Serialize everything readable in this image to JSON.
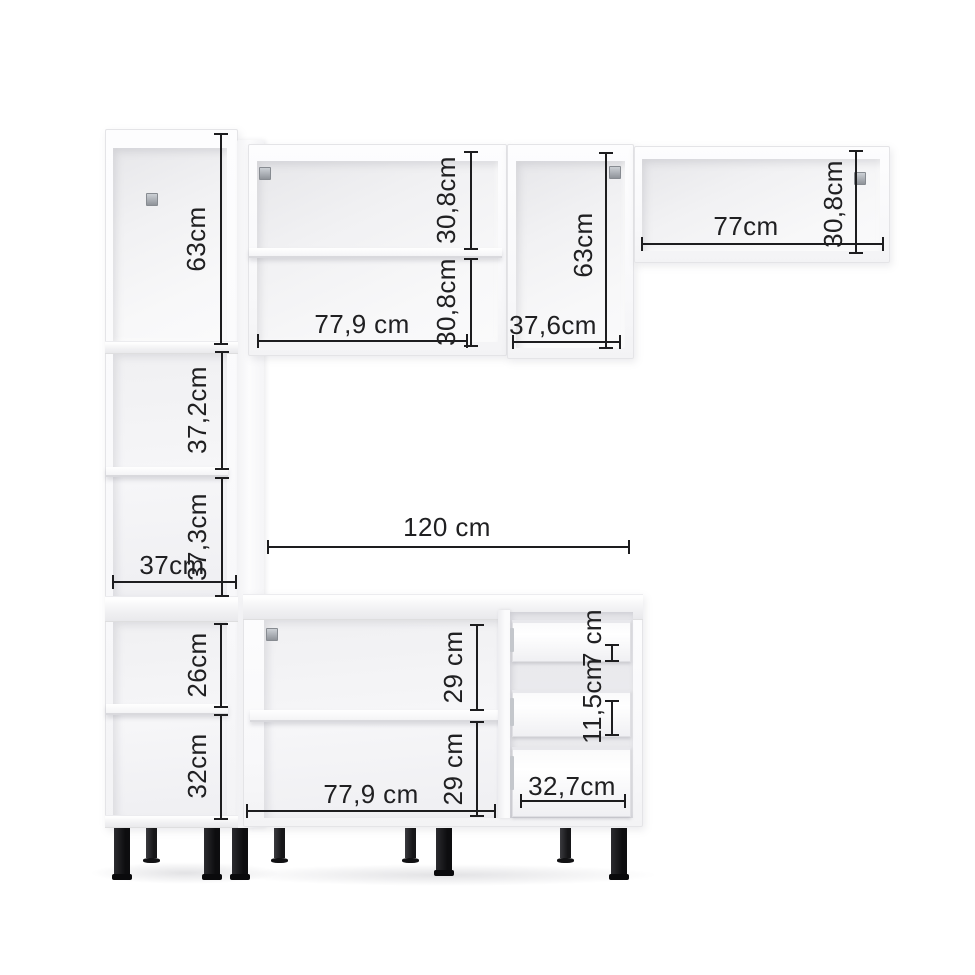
{
  "scene": {
    "background": "#ffffff",
    "dimension_line_color": "#1d1d1f",
    "label_color": "#202022",
    "cabinet_color": "#fbfbfd",
    "interior_shade_color": "#e9e9ec",
    "leg_color": "#141416",
    "hinge_color": "#a8acb2"
  },
  "cabinets": {
    "tall_left": {
      "dims": {
        "upper_height": "63cm",
        "niche_upper_height": "37,2cm",
        "niche_lower_height": "37,3cm",
        "width": "37cm",
        "base_upper_height": "26cm",
        "base_lower_height": "32cm"
      }
    },
    "wall_wide": {
      "dims": {
        "section_upper_height": "30,8cm",
        "section_lower_height": "30,8cm",
        "width": "77,9 cm"
      }
    },
    "wall_tall": {
      "dims": {
        "width": "37,6cm",
        "height": "63cm"
      }
    },
    "wall_right": {
      "dims": {
        "width": "77cm",
        "height": "30,8cm"
      }
    },
    "base_wide": {
      "dims": {
        "span": "120 cm",
        "section_upper_height": "29 cm",
        "section_lower_height": "29 cm",
        "width": "77,9 cm"
      }
    },
    "base_drawers": {
      "dims": {
        "top_drawer_height": "7 cm",
        "middle_drawer_height": "11,5cm",
        "drawer_width": "32,7cm"
      }
    }
  }
}
